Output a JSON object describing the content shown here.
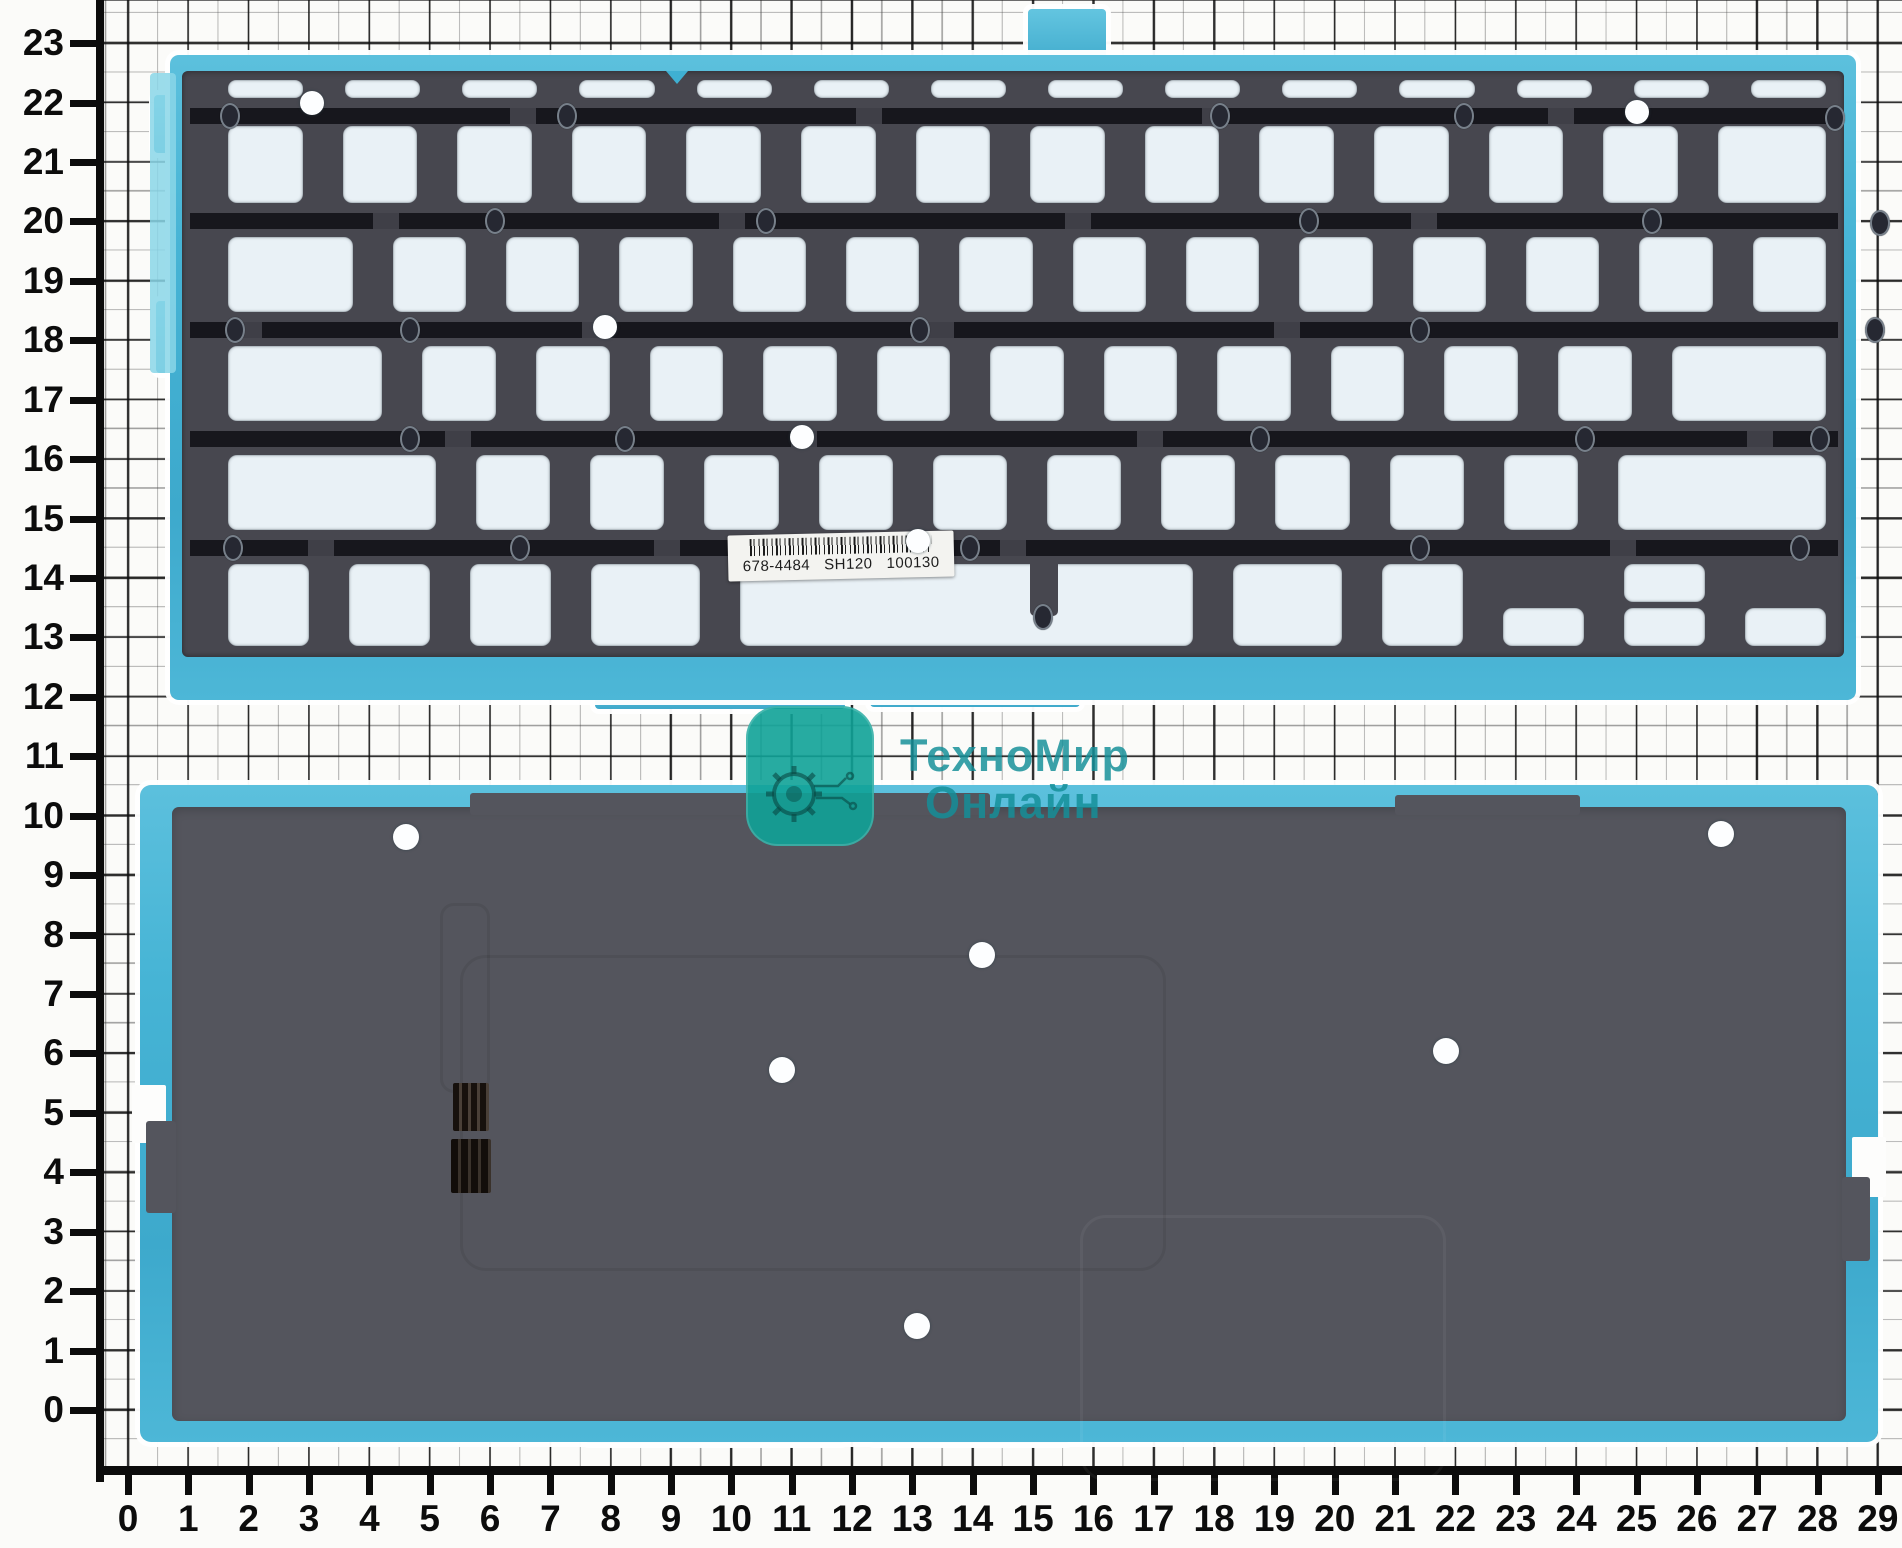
{
  "scene": {
    "width": 1902,
    "height": 1548,
    "background": "#fbfbf9",
    "description": "scan of MacBook keyboard backlight film (front and back) on centimeter graph paper"
  },
  "rulers": {
    "left_values": [
      23,
      22,
      21,
      20,
      19,
      18,
      17,
      16,
      15,
      14,
      13,
      12,
      11,
      10,
      9,
      8,
      7,
      6,
      5,
      4,
      3,
      2,
      1,
      0
    ],
    "bottom_values": [
      0,
      1,
      2,
      3,
      4,
      5,
      6,
      7,
      8,
      9,
      10,
      11,
      12,
      13,
      14,
      15,
      16,
      17,
      18,
      19,
      20,
      21,
      22,
      23,
      24,
      25,
      26,
      27,
      28,
      29
    ],
    "left_y0": 1410,
    "left_step": 59.43,
    "bottom_x0": 128,
    "bottom_step": 60.34,
    "color": "#0c0c0c"
  },
  "watermark": {
    "line1": "ТехноМир",
    "line2": "Онлайн",
    "logo_icon": "gear-icon",
    "logo_color": "#10a297",
    "text_color": "#148f98",
    "logo_x": 746,
    "logo_y": 706,
    "line1_x": 900,
    "line1_y": 733,
    "line2_x": 925,
    "line2_y": 780
  },
  "top_film": {
    "x": 170,
    "y": 55,
    "w": 1686,
    "h": 645,
    "body_color": "#47474f",
    "band_color": "#17171d",
    "window_color": "#e9f1f6",
    "edge_color": "#46b4d5",
    "bands_y": [
      53,
      158,
      267,
      376,
      485
    ],
    "rows": [
      {
        "name": "function-row",
        "y": 25,
        "h": 18,
        "gap": 42,
        "slot": true,
        "keys": [
          1,
          1,
          1,
          1,
          1,
          1,
          1,
          1,
          1,
          1,
          1,
          1,
          1,
          1
        ]
      },
      {
        "name": "number-row",
        "y": 71,
        "h": 77,
        "gap": 40,
        "keys": [
          1,
          1,
          1,
          1,
          1,
          1,
          1,
          1,
          1,
          1,
          1,
          1,
          1,
          1.45
        ]
      },
      {
        "name": "qwerty-row",
        "y": 182,
        "h": 75,
        "gap": 40,
        "keys": [
          1.7,
          1,
          1,
          1,
          1,
          1,
          1,
          1,
          1,
          1,
          1,
          1,
          1,
          1
        ]
      },
      {
        "name": "home-row",
        "y": 291,
        "h": 75,
        "gap": 40,
        "keys": [
          2.1,
          1,
          1,
          1,
          1,
          1,
          1,
          1,
          1,
          1,
          1,
          1,
          2.1
        ]
      },
      {
        "name": "shift-row",
        "y": 400,
        "h": 75,
        "gap": 40,
        "keys": [
          2.8,
          1,
          1,
          1,
          1,
          1,
          1,
          1,
          1,
          1,
          1,
          2.8
        ]
      },
      {
        "name": "bottom-row",
        "y": 509,
        "h": 82,
        "gap": 40,
        "keys": [
          1,
          1,
          1,
          1.35,
          {
            "u": 5.6,
            "space": true
          },
          1.35,
          1,
          {
            "u": 1,
            "half": "bottom"
          },
          {
            "u": 1,
            "stack": true
          },
          {
            "u": 1,
            "half": "bottom"
          }
        ]
      }
    ],
    "dark_holes": [
      [
        50,
        61
      ],
      [
        387,
        61
      ],
      [
        1040,
        61
      ],
      [
        1284,
        61
      ],
      [
        1655,
        63
      ],
      [
        315,
        166
      ],
      [
        586,
        166
      ],
      [
        1129,
        166
      ],
      [
        1472,
        166
      ],
      [
        1700,
        168
      ],
      [
        55,
        275
      ],
      [
        230,
        275
      ],
      [
        740,
        275
      ],
      [
        1240,
        275
      ],
      [
        1695,
        275
      ],
      [
        230,
        384
      ],
      [
        445,
        384
      ],
      [
        1080,
        384
      ],
      [
        1405,
        384
      ],
      [
        1640,
        384
      ],
      [
        53,
        493
      ],
      [
        340,
        493
      ],
      [
        790,
        493
      ],
      [
        1240,
        493
      ],
      [
        1620,
        493
      ]
    ],
    "white_holes": [
      [
        130,
        48
      ],
      [
        1455,
        57
      ],
      [
        423,
        272
      ],
      [
        620,
        382
      ],
      [
        736,
        486
      ]
    ],
    "label": {
      "x": 558,
      "y": 478,
      "w": 226,
      "h": 46,
      "icon": "barcode",
      "part_number": "678-4484",
      "model_code": "SH120",
      "lot_code": "100130"
    }
  },
  "bottom_film": {
    "x": 140,
    "y": 785,
    "w": 1738,
    "h": 657,
    "body_color": "#54555d",
    "edge_color": "#46b4d5",
    "white_holes": [
      [
        253,
        51
      ],
      [
        1568,
        48
      ],
      [
        829,
        169
      ],
      [
        629,
        284
      ],
      [
        1293,
        265
      ],
      [
        764,
        540
      ]
    ],
    "connector": {
      "x": 313,
      "y": 298
    }
  }
}
